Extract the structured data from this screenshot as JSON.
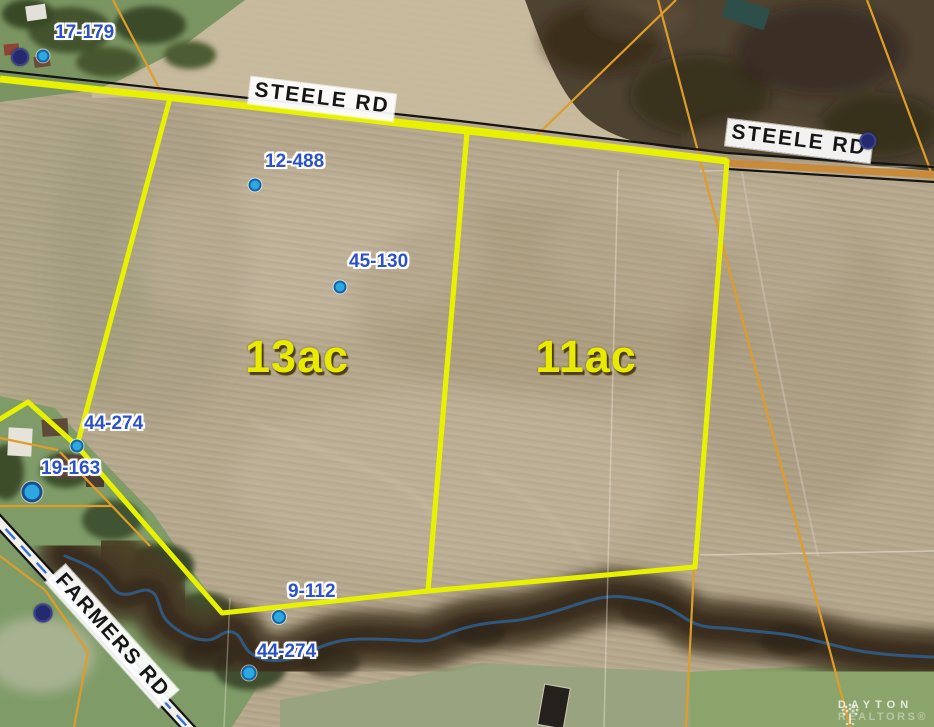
{
  "map": {
    "parcels": [
      {
        "label": "13ac",
        "cx": 297,
        "cy": 357
      },
      {
        "label": "11ac",
        "cx": 586,
        "cy": 357
      }
    ],
    "road_labels": [
      {
        "text": "STEELE RD",
        "cx": 322,
        "cy": 99,
        "rotation_deg": 7
      },
      {
        "text": "STEELE RD",
        "cx": 799,
        "cy": 141,
        "rotation_deg": 7
      },
      {
        "text": "FARMERS RD",
        "cx": 112,
        "cy": 636,
        "rotation_deg": 48
      }
    ],
    "point_labels": [
      {
        "text": "17-179",
        "x": 55,
        "y": 22
      },
      {
        "text": "12-488",
        "x": 265,
        "y": 151
      },
      {
        "text": "45-130",
        "x": 349,
        "y": 251
      },
      {
        "text": "44-274",
        "x": 84,
        "y": 413
      },
      {
        "text": "19-163",
        "x": 41,
        "y": 458
      },
      {
        "text": "9-112",
        "x": 288,
        "y": 581
      },
      {
        "text": "44-274",
        "x": 257,
        "y": 641
      }
    ],
    "dots": [
      {
        "type": "navy",
        "x": 20,
        "y": 57,
        "size": 18
      },
      {
        "type": "blue",
        "x": 43,
        "y": 56,
        "size": 13
      },
      {
        "type": "blue",
        "x": 255,
        "y": 185,
        "size": 13
      },
      {
        "type": "blue",
        "x": 340,
        "y": 287,
        "size": 13
      },
      {
        "type": "blue",
        "x": 77,
        "y": 446,
        "size": 13
      },
      {
        "type": "blue-large",
        "x": 32,
        "y": 492,
        "size": 21
      },
      {
        "type": "blue",
        "x": 279,
        "y": 617,
        "size": 14
      },
      {
        "type": "blue",
        "x": 249,
        "y": 673,
        "size": 15
      },
      {
        "type": "navy",
        "x": 868,
        "y": 141,
        "size": 17
      },
      {
        "type": "navy",
        "x": 43,
        "y": 613,
        "size": 19
      }
    ],
    "colors": {
      "boundary_yellow": "#e8f200",
      "parcel_line_orange": "#df9d28",
      "marker_blue": "#2da9e1",
      "marker_navy": "#252a6e",
      "label_blue": "#2b52c8",
      "acreage_yellow": "#e8ea00",
      "stream_blue": "#2f5d8a"
    }
  },
  "watermark": {
    "brand_top": "DAYTON",
    "brand_bottom": "REALTORS®"
  }
}
